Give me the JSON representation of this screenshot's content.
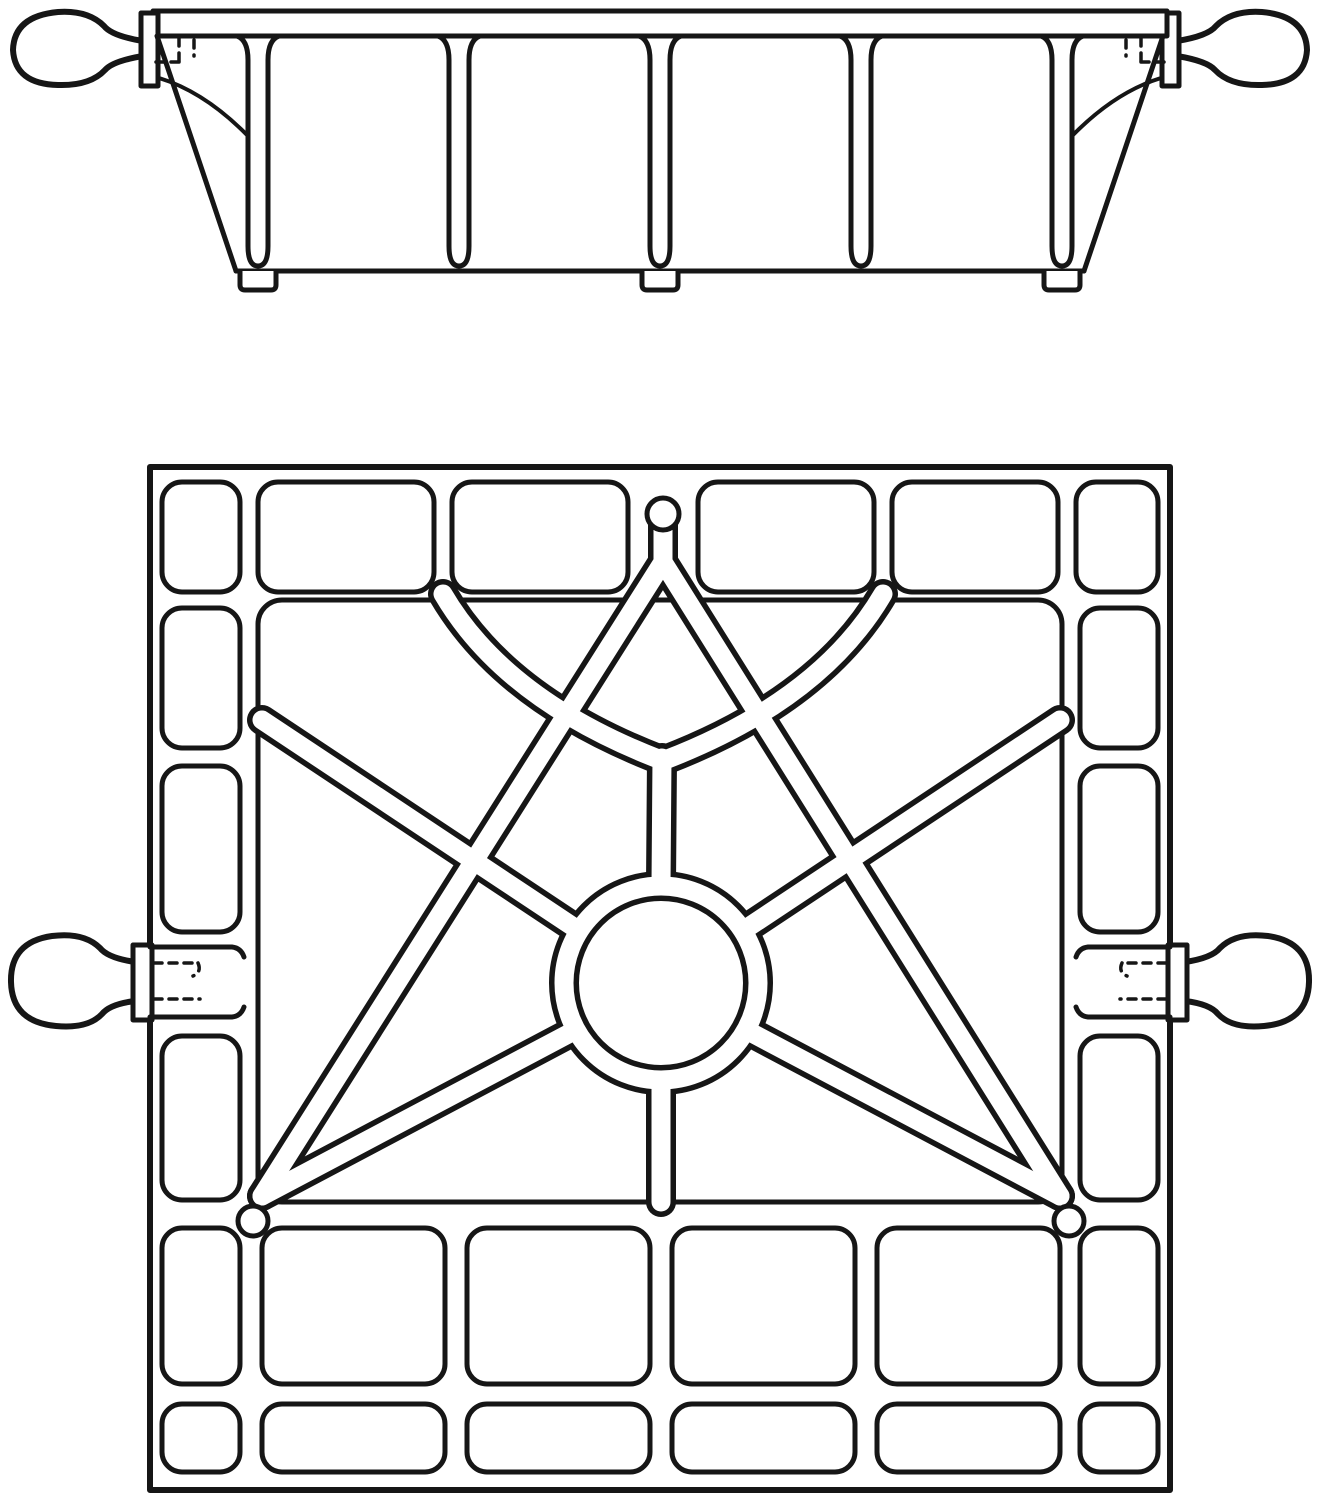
{
  "drawing": {
    "ink": "#161616",
    "paper": "#ffffff",
    "line_width": 5,
    "frame_line_width": 6,
    "dash_pattern": "8 7",
    "mirror_axis_translate": 1320,
    "elevation": {
      "bar": {
        "x": 153,
        "y": 11,
        "w": 1014,
        "h": 25
      },
      "end_plate": {
        "x": 141,
        "y": 13,
        "w": 17,
        "h": 73
      },
      "knob_path": "M143,41 Q112,36 104,26 Q88,10 58,12 Q14,16 13,50 Q15,84 58,85 Q90,86 105,70 Q113,61 143,56 Z",
      "slant": {
        "x1": 157,
        "y1": 36,
        "x2": 236,
        "y2": 271
      },
      "bottom_edge": {
        "x1": 236,
        "y1": 271,
        "x2": 1084,
        "y2": 271
      },
      "gusset_path": "M159,78 Q205,92 248,136",
      "rib_centers": [
        258,
        459,
        660,
        861,
        1062
      ],
      "rib_top_y": 36,
      "rib_bottom_y": 246,
      "rib_half_w": 10,
      "rib_flare": 21,
      "feet": [
        {
          "x1": 240,
          "x2": 276
        },
        {
          "x1": 642,
          "x2": 678
        },
        {
          "x1": 1044,
          "x2": 1080
        }
      ],
      "foot_top": 271,
      "foot_bottom": 290,
      "hidden_dashes": [
        "M179,38 L179,64",
        "M156,62 L186,62",
        "M194,40 L194,56"
      ]
    },
    "plan": {
      "frame": {
        "x": 150,
        "y": 467,
        "w": 1020,
        "h": 1023
      },
      "inner_field": {
        "x": 258,
        "y": 600,
        "w": 804,
        "h": 602,
        "rx": 24
      },
      "cell_rx": 20,
      "cells": [
        {
          "x": 162,
          "y": 482,
          "w": 78,
          "h": 110
        },
        {
          "x": 258,
          "y": 482,
          "w": 176,
          "h": 110
        },
        {
          "x": 452,
          "y": 482,
          "w": 176,
          "h": 110
        },
        {
          "x": 698,
          "y": 482,
          "w": 176,
          "h": 110
        },
        {
          "x": 892,
          "y": 482,
          "w": 166,
          "h": 110
        },
        {
          "x": 1076,
          "y": 482,
          "w": 82,
          "h": 110
        },
        {
          "x": 162,
          "y": 608,
          "w": 78,
          "h": 140
        },
        {
          "x": 162,
          "y": 766,
          "w": 78,
          "h": 166
        },
        {
          "x": 162,
          "y": 1036,
          "w": 78,
          "h": 164
        },
        {
          "x": 1080,
          "y": 608,
          "w": 78,
          "h": 140
        },
        {
          "x": 1080,
          "y": 766,
          "w": 78,
          "h": 166
        },
        {
          "x": 1080,
          "y": 1036,
          "w": 78,
          "h": 164
        },
        {
          "x": 162,
          "y": 1228,
          "w": 78,
          "h": 156
        },
        {
          "x": 262,
          "y": 1228,
          "w": 183,
          "h": 156
        },
        {
          "x": 467,
          "y": 1228,
          "w": 183,
          "h": 156
        },
        {
          "x": 672,
          "y": 1228,
          "w": 183,
          "h": 156
        },
        {
          "x": 877,
          "y": 1228,
          "w": 183,
          "h": 156
        },
        {
          "x": 1080,
          "y": 1228,
          "w": 78,
          "h": 156
        },
        {
          "x": 162,
          "y": 1404,
          "w": 78,
          "h": 68
        },
        {
          "x": 262,
          "y": 1404,
          "w": 183,
          "h": 68
        },
        {
          "x": 467,
          "y": 1404,
          "w": 183,
          "h": 68
        },
        {
          "x": 672,
          "y": 1404,
          "w": 183,
          "h": 68
        },
        {
          "x": 877,
          "y": 1404,
          "w": 183,
          "h": 68
        },
        {
          "x": 1080,
          "y": 1404,
          "w": 78,
          "h": 68
        }
      ],
      "top_boss_circle": {
        "cx": 663,
        "cy": 514,
        "r": 16
      },
      "corner_boss_circles": [
        {
          "cx": 253,
          "cy": 1221,
          "r": 15
        },
        {
          "cx": 1069,
          "cy": 1221,
          "r": 15
        }
      ],
      "star": {
        "rib_outer_w": 30,
        "rib_inner_w": 19,
        "ring": {
          "cx": 661,
          "cy": 983,
          "r": 97
        },
        "rib_paths": [
          "M663,520 L663,562",
          "M663,562 L262,1196",
          "M663,562 L1060,1196",
          "M262,720 L578,930",
          "M1060,720 L744,930",
          "M572,1032 L262,1196",
          "M750,1032 L1060,1196",
          "M661,884 L662,758",
          "M661,1080 L661,1202",
          "M443,594 Q505,700 661,760",
          "M883,594 Q821,700 665,760"
        ]
      },
      "handle": {
        "plate": {
          "x": 133,
          "y": 945,
          "w": 19,
          "h": 75
        },
        "knob_path": "M135,962 Q108,958 100,948 Q84,932 52,936 Q10,942 11,982 Q12,1022 56,1026 Q88,1029 102,1014 Q110,1004 135,1001 Z",
        "boss_lines": [
          "M150,947 L232,947 Q241,948 244,957",
          "M150,1017 L232,1017 Q241,1016 244,1007"
        ],
        "hidden_dashes": [
          "M154,963 L198,963",
          "M198,963 Q202,972 193,976",
          "M154,999 L200,999"
        ]
      }
    }
  }
}
